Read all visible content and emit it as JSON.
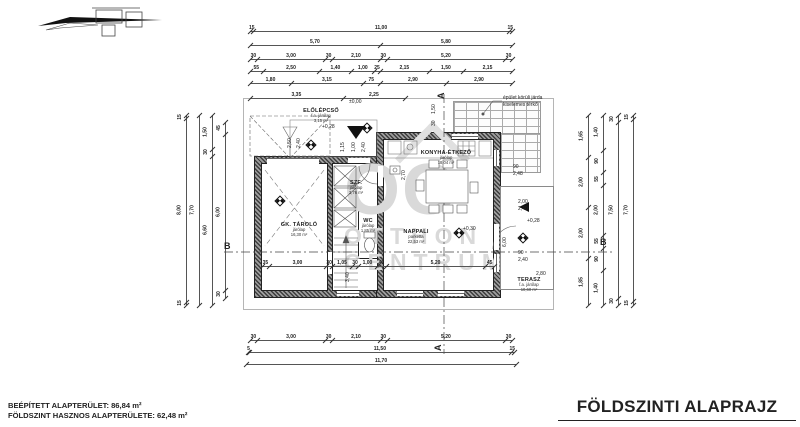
{
  "footer": {
    "area_line1": "BEÉPÍTETT ALAPTERÜLET: 86,84 m²",
    "area_line2": "FÖLDSZINT HASZNOS ALAPTERÜLETE: 62,48 m²",
    "title": "FÖLDSZINTI ALAPRAJZ"
  },
  "watermark": {
    "oc": "OC",
    "line1": "OTTHON",
    "line2": "CENTRUM"
  },
  "plan": {
    "rooms": [
      {
        "name": "ELŐLÉPCSŐ",
        "finish": "f.a. járólap",
        "area": "3,15 m²",
        "x": 321,
        "y": 108
      },
      {
        "name": "GK. TÁROLÓ",
        "finish": "járólap",
        "area": "16,30 m²",
        "x": 299,
        "y": 222
      },
      {
        "name": "SZF.",
        "finish": "járólap",
        "area": "3,76 m²",
        "x": 356,
        "y": 180
      },
      {
        "name": "WC",
        "finish": "járólap",
        "area": "1,85 m²",
        "x": 368,
        "y": 218
      },
      {
        "name": "KONYHA-ÉTKEZŐ",
        "finish": "járólap",
        "area": "18,04 m²",
        "x": 446,
        "y": 150
      },
      {
        "name": "NAPPALI",
        "finish": "parketta",
        "area": "22,53 m²",
        "x": 416,
        "y": 229
      },
      {
        "name": "TERASZ",
        "finish": "f.a. járólap",
        "area": "10,60 m²",
        "x": 529,
        "y": 277
      }
    ],
    "levels": [
      {
        "x": 363,
        "y": 124
      },
      {
        "x": 307,
        "y": 141
      },
      {
        "x": 276,
        "y": 197
      },
      {
        "x": 455,
        "y": 229
      },
      {
        "x": 519,
        "y": 234
      }
    ],
    "annotations": [
      {
        "t": "±0,00",
        "x": 349,
        "y": 100
      },
      {
        "t": "+0,28",
        "x": 322,
        "y": 125
      },
      {
        "t": "1,15",
        "x": 341,
        "y": 152,
        "r": 1
      },
      {
        "t": "1,00",
        "x": 352,
        "y": 152,
        "r": 1
      },
      {
        "t": "2,40",
        "x": 362,
        "y": 152,
        "r": 1
      },
      {
        "t": "2,50",
        "x": 288,
        "y": 148,
        "r": 1
      },
      {
        "t": "2,40",
        "x": 297,
        "y": 148,
        "r": 1
      },
      {
        "t": "1,50",
        "x": 432,
        "y": 114,
        "r": 1
      },
      {
        "t": "30",
        "x": 432,
        "y": 126,
        "r": 1
      },
      {
        "t": "2,70",
        "x": 402,
        "y": 180,
        "r": 1
      },
      {
        "t": "90",
        "x": 513,
        "y": 165
      },
      {
        "t": "2,48",
        "x": 513,
        "y": 172
      },
      {
        "t": "2,00",
        "x": 518,
        "y": 200
      },
      {
        "t": "2,40",
        "x": 518,
        "y": 207
      },
      {
        "t": "+0,28",
        "x": 527,
        "y": 219
      },
      {
        "t": "+0,30",
        "x": 463,
        "y": 227
      },
      {
        "t": "90",
        "x": 518,
        "y": 251
      },
      {
        "t": "2,40",
        "x": 518,
        "y": 258
      },
      {
        "t": "2,80",
        "x": 536,
        "y": 272
      },
      {
        "t": "6,00",
        "x": 503,
        "y": 247,
        "r": 1
      },
      {
        "t": "3,40",
        "x": 346,
        "y": 282,
        "r": 1
      },
      {
        "t": "épület körüli járda",
        "x": 503,
        "y": 96
      },
      {
        "t": "kiselemes térkő",
        "x": 503,
        "y": 103
      },
      {
        "t": "A",
        "x": 437,
        "y": 99,
        "fs": 9,
        "b": 1,
        "r": 1
      },
      {
        "t": "A",
        "x": 434,
        "y": 351,
        "fs": 9,
        "b": 1,
        "r": 1
      },
      {
        "t": "B",
        "x": 224,
        "y": 242,
        "fs": 9,
        "b": 1
      },
      {
        "t": "B",
        "x": 600,
        "y": 238,
        "fs": 9,
        "b": 1
      }
    ],
    "chains": [
      {
        "x": 250,
        "y": 24,
        "len": 262,
        "o": "h",
        "segs": [
          "15",
          "11,00",
          "15"
        ]
      },
      {
        "x": 250,
        "y": 38,
        "len": 262,
        "o": "h",
        "segs": [
          "5,70",
          "5,80"
        ]
      },
      {
        "x": 250,
        "y": 52,
        "len": 262,
        "o": "h",
        "segs": [
          "30",
          "3,00",
          "30",
          "2,10",
          "30",
          "5,20",
          "30"
        ]
      },
      {
        "x": 250,
        "y": 64,
        "len": 262,
        "o": "h",
        "segs": [
          "55",
          "2,50",
          "1,40",
          "1,00",
          "25",
          "2,15",
          "1,50",
          "2,15"
        ]
      },
      {
        "x": 250,
        "y": 76,
        "len": 262,
        "o": "h",
        "segs": [
          "1,80",
          "3,15",
          "75",
          "2,90",
          "2,90"
        ]
      },
      {
        "x": 250,
        "y": 91,
        "len": 155,
        "o": "h",
        "segs": [
          "3,35",
          "2,25"
        ]
      },
      {
        "x": 262,
        "y": 259,
        "len": 232,
        "o": "h",
        "segs": [
          "35",
          "3,00",
          "30",
          "1,05",
          "30",
          "1,00",
          "45",
          "5,20",
          "45"
        ]
      },
      {
        "x": 250,
        "y": 333,
        "len": 262,
        "o": "h",
        "segs": [
          "30",
          "3,00",
          "30",
          "2,10",
          "30",
          "5,20",
          "30"
        ]
      },
      {
        "x": 248,
        "y": 345,
        "len": 266,
        "o": "h",
        "segs": [
          "5",
          "11,50",
          "15"
        ]
      },
      {
        "x": 246,
        "y": 357,
        "len": 270,
        "o": "h",
        "segs": [
          "11,70"
        ]
      },
      {
        "x": 181,
        "y": 115,
        "len": 190,
        "o": "v",
        "segs": [
          "15",
          "8,00",
          "15"
        ]
      },
      {
        "x": 194,
        "y": 115,
        "len": 190,
        "o": "v",
        "segs": [
          "7,70"
        ]
      },
      {
        "x": 207,
        "y": 115,
        "len": 190,
        "o": "v",
        "segs": [
          "1,50",
          "30",
          "6,60"
        ]
      },
      {
        "x": 220,
        "y": 122,
        "len": 176,
        "o": "v",
        "segs": [
          "45",
          "6,00",
          "30"
        ]
      },
      {
        "x": 583,
        "y": 115,
        "len": 190,
        "o": "v",
        "segs": [
          "1,65",
          "2,00",
          "2,00",
          "1,85"
        ]
      },
      {
        "x": 598,
        "y": 115,
        "len": 190,
        "o": "v",
        "segs": [
          "1,40",
          "90",
          "55",
          "2,00",
          "55",
          "90",
          "1,40"
        ]
      },
      {
        "x": 613,
        "y": 115,
        "len": 190,
        "o": "v",
        "segs": [
          "30",
          "7,50",
          "30"
        ]
      },
      {
        "x": 628,
        "y": 115,
        "len": 190,
        "o": "v",
        "segs": [
          "15",
          "7,70",
          "15"
        ]
      }
    ]
  }
}
